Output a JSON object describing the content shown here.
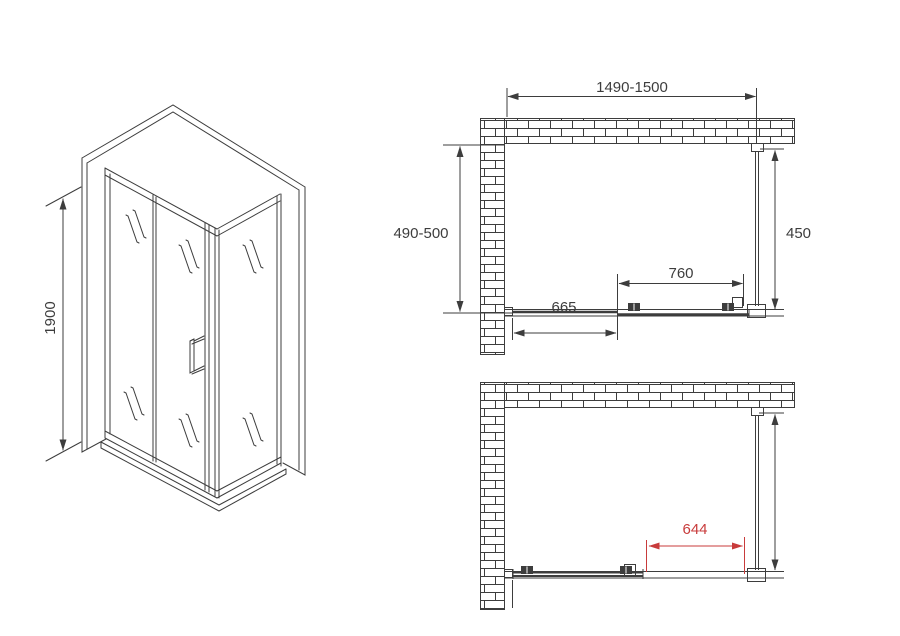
{
  "colors": {
    "line": "#3d3d3d",
    "accent_red": "#c83b3b",
    "background": "#ffffff"
  },
  "views": {
    "isometric": {
      "height_dimension": "1900"
    },
    "plan_closed": {
      "overall_width": "1490-1500",
      "wall_depth": "490-500",
      "side_panel_depth": "450",
      "door_width": "760",
      "fixed_panel_width": "665"
    },
    "plan_open": {
      "opening_width": "644"
    }
  }
}
